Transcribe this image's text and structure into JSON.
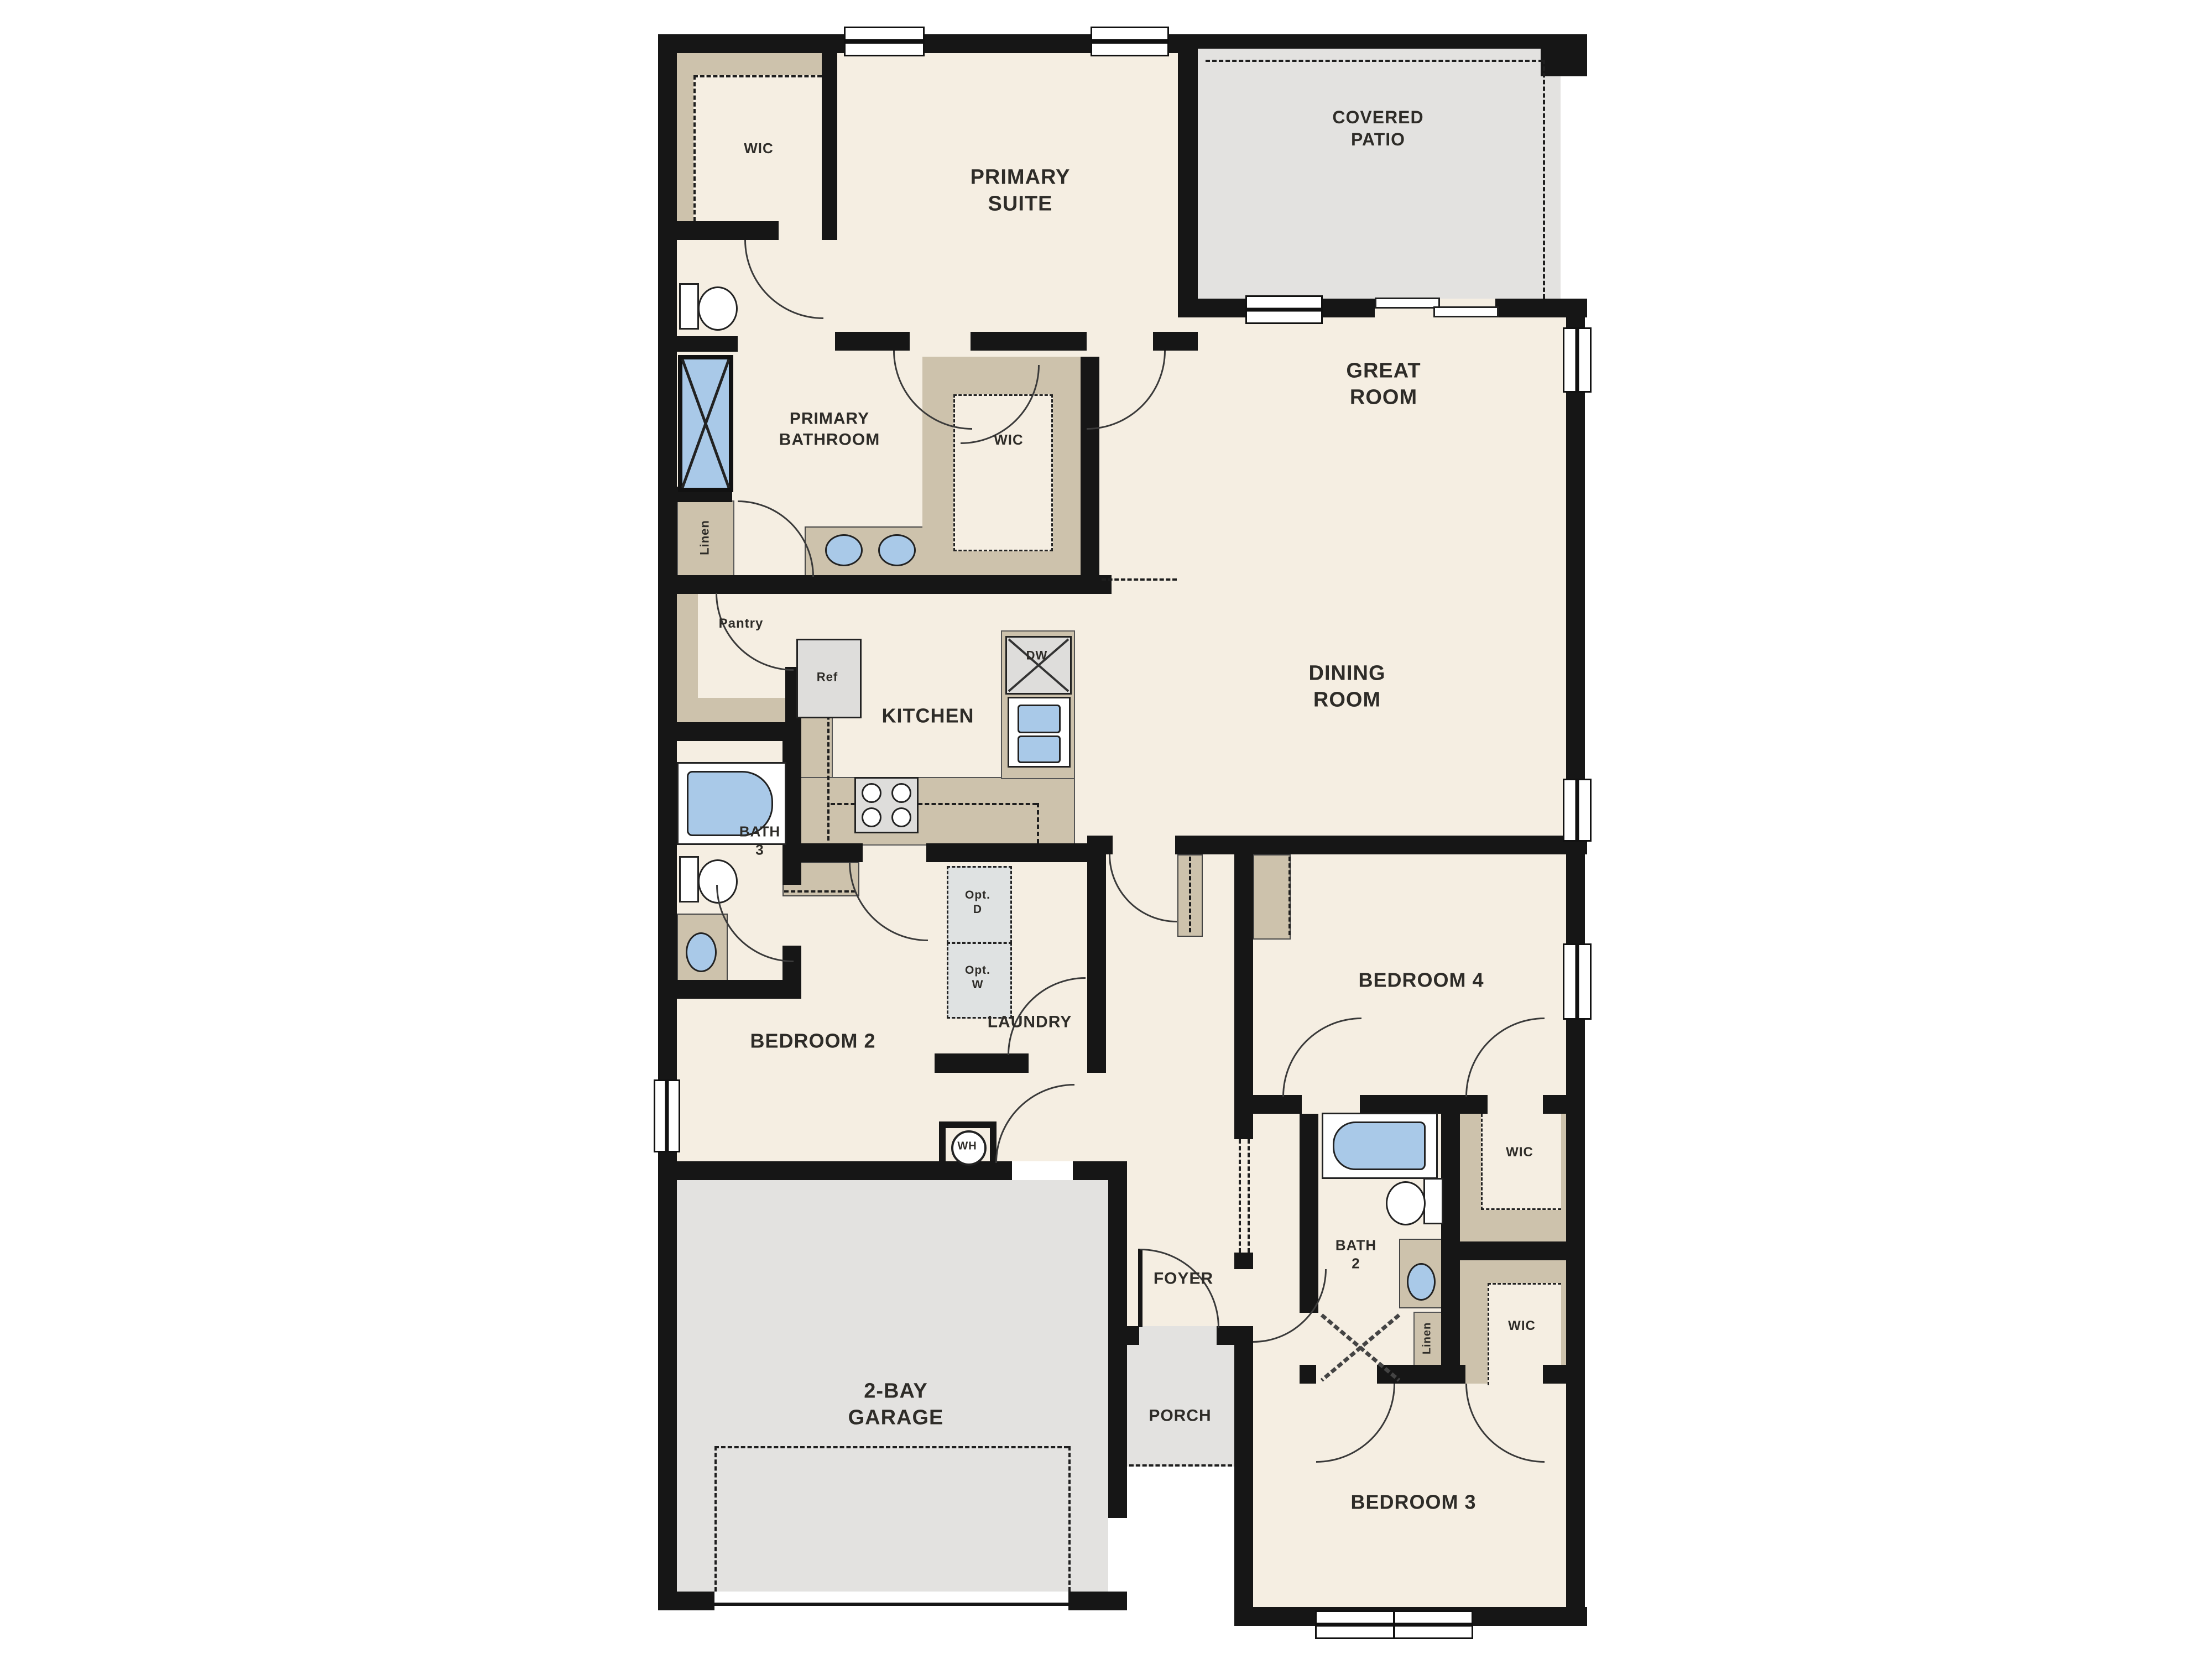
{
  "plan": {
    "rooms": {
      "wic_primary": "WIC",
      "primary_suite": "PRIMARY\nSUITE",
      "covered_patio": "COVERED\nPATIO",
      "primary_bathroom": "PRIMARY\nBATHROOM",
      "wic_primary_2": "WIC",
      "linen_primary": "Linen",
      "great_room": "GREAT\nROOM",
      "pantry": "Pantry",
      "kitchen": "KITCHEN",
      "dining_room": "DINING\nROOM",
      "bath_3": "BATH\n3",
      "bedroom_2": "BEDROOM 2",
      "laundry": "LAUNDRY",
      "bedroom_4": "BEDROOM 4",
      "foyer": "FOYER",
      "bath_2": "BATH\n2",
      "wic_bedroom_4": "WIC",
      "wic_bedroom_3": "WIC",
      "linen_hall": "Linen",
      "garage": "2-BAY\nGARAGE",
      "porch": "PORCH",
      "bedroom_3": "BEDROOM 3"
    },
    "appliances": {
      "refrigerator": "Ref",
      "dishwasher": "DW",
      "optional_dryer": "Opt.\nD",
      "optional_washer": "Opt.\nW",
      "water_heater": "WH"
    },
    "colors": {
      "wall": "#161616",
      "floor": "#f5eee2",
      "closet_shelving": "#cdc2ac",
      "concrete": "#e3e2e0",
      "fixture_blue": "#a9c9e8"
    }
  }
}
